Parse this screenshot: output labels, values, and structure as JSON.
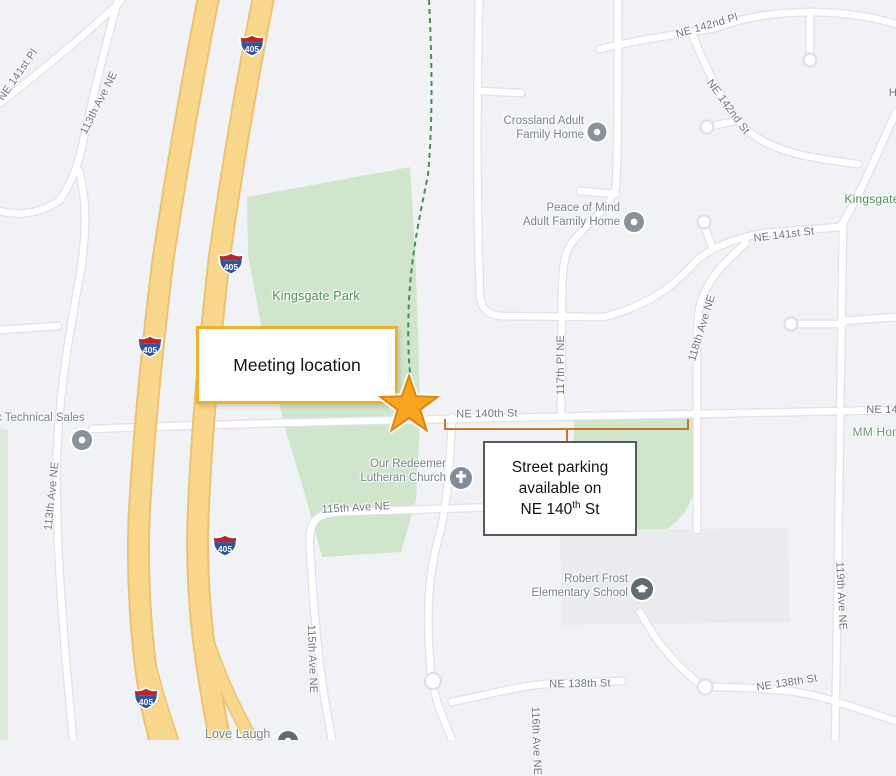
{
  "map": {
    "shield": "405",
    "street_labels": [
      {
        "text": "NE 141st Pl"
      },
      {
        "text": "113th Ave NE"
      },
      {
        "text": "113th Ave NE"
      },
      {
        "text": "115th Ave NE"
      },
      {
        "text": "115th Ave NE"
      },
      {
        "text": "116th Ave NE"
      },
      {
        "text": "117th Pl NE"
      },
      {
        "text": "118th Ave NE"
      },
      {
        "text": "119th Ave NE"
      },
      {
        "text": "NE 140th St"
      },
      {
        "text": "NE 140th St"
      },
      {
        "text": "NE 141st St"
      },
      {
        "text": "NE 142nd Pl"
      },
      {
        "text": "NE 142nd St"
      },
      {
        "text": "NE 138th St"
      },
      {
        "text": "NE 138th St"
      },
      {
        "text": "H"
      },
      {
        "text": "Kingsgate"
      },
      {
        "text": "MM Homes"
      },
      {
        "text": "Kingsgate Park"
      }
    ],
    "pois": {
      "crossland": {
        "line1": "Crossland Adult",
        "line2": "Family Home"
      },
      "peace_of_mind": {
        "line1": "Peace of Mind",
        "line2": "Adult Family Home"
      },
      "church": {
        "line1": "Our Redeemer",
        "line2": "Lutheran Church"
      },
      "school": {
        "line1": "Robert Frost",
        "line2": "Elementary School"
      },
      "technical_sales": {
        "line1": "c Technical Sales"
      },
      "love_laugh": {
        "line1": "Love Laugh"
      }
    },
    "colors": {
      "park_green": "#cfe6cd",
      "park_boundary_dash": "#4a8c55",
      "highway_yellow": "#f8d78d",
      "road_white": "#ffffff",
      "street_label_gray": "#6f757c",
      "park_label_green": "#4d8f58"
    }
  },
  "annotations": {
    "meeting_box": {
      "label": "Meeting location",
      "border_color": "#efb02c"
    },
    "parking_box": {
      "line1": "Street parking",
      "line2": "available on",
      "line3_street": "NE 140",
      "line3_sup": "th",
      "line3_suffix": " St",
      "border_color": "#58595b"
    },
    "star_color": "#f9a51f",
    "bracket_color": "#c5772e"
  }
}
